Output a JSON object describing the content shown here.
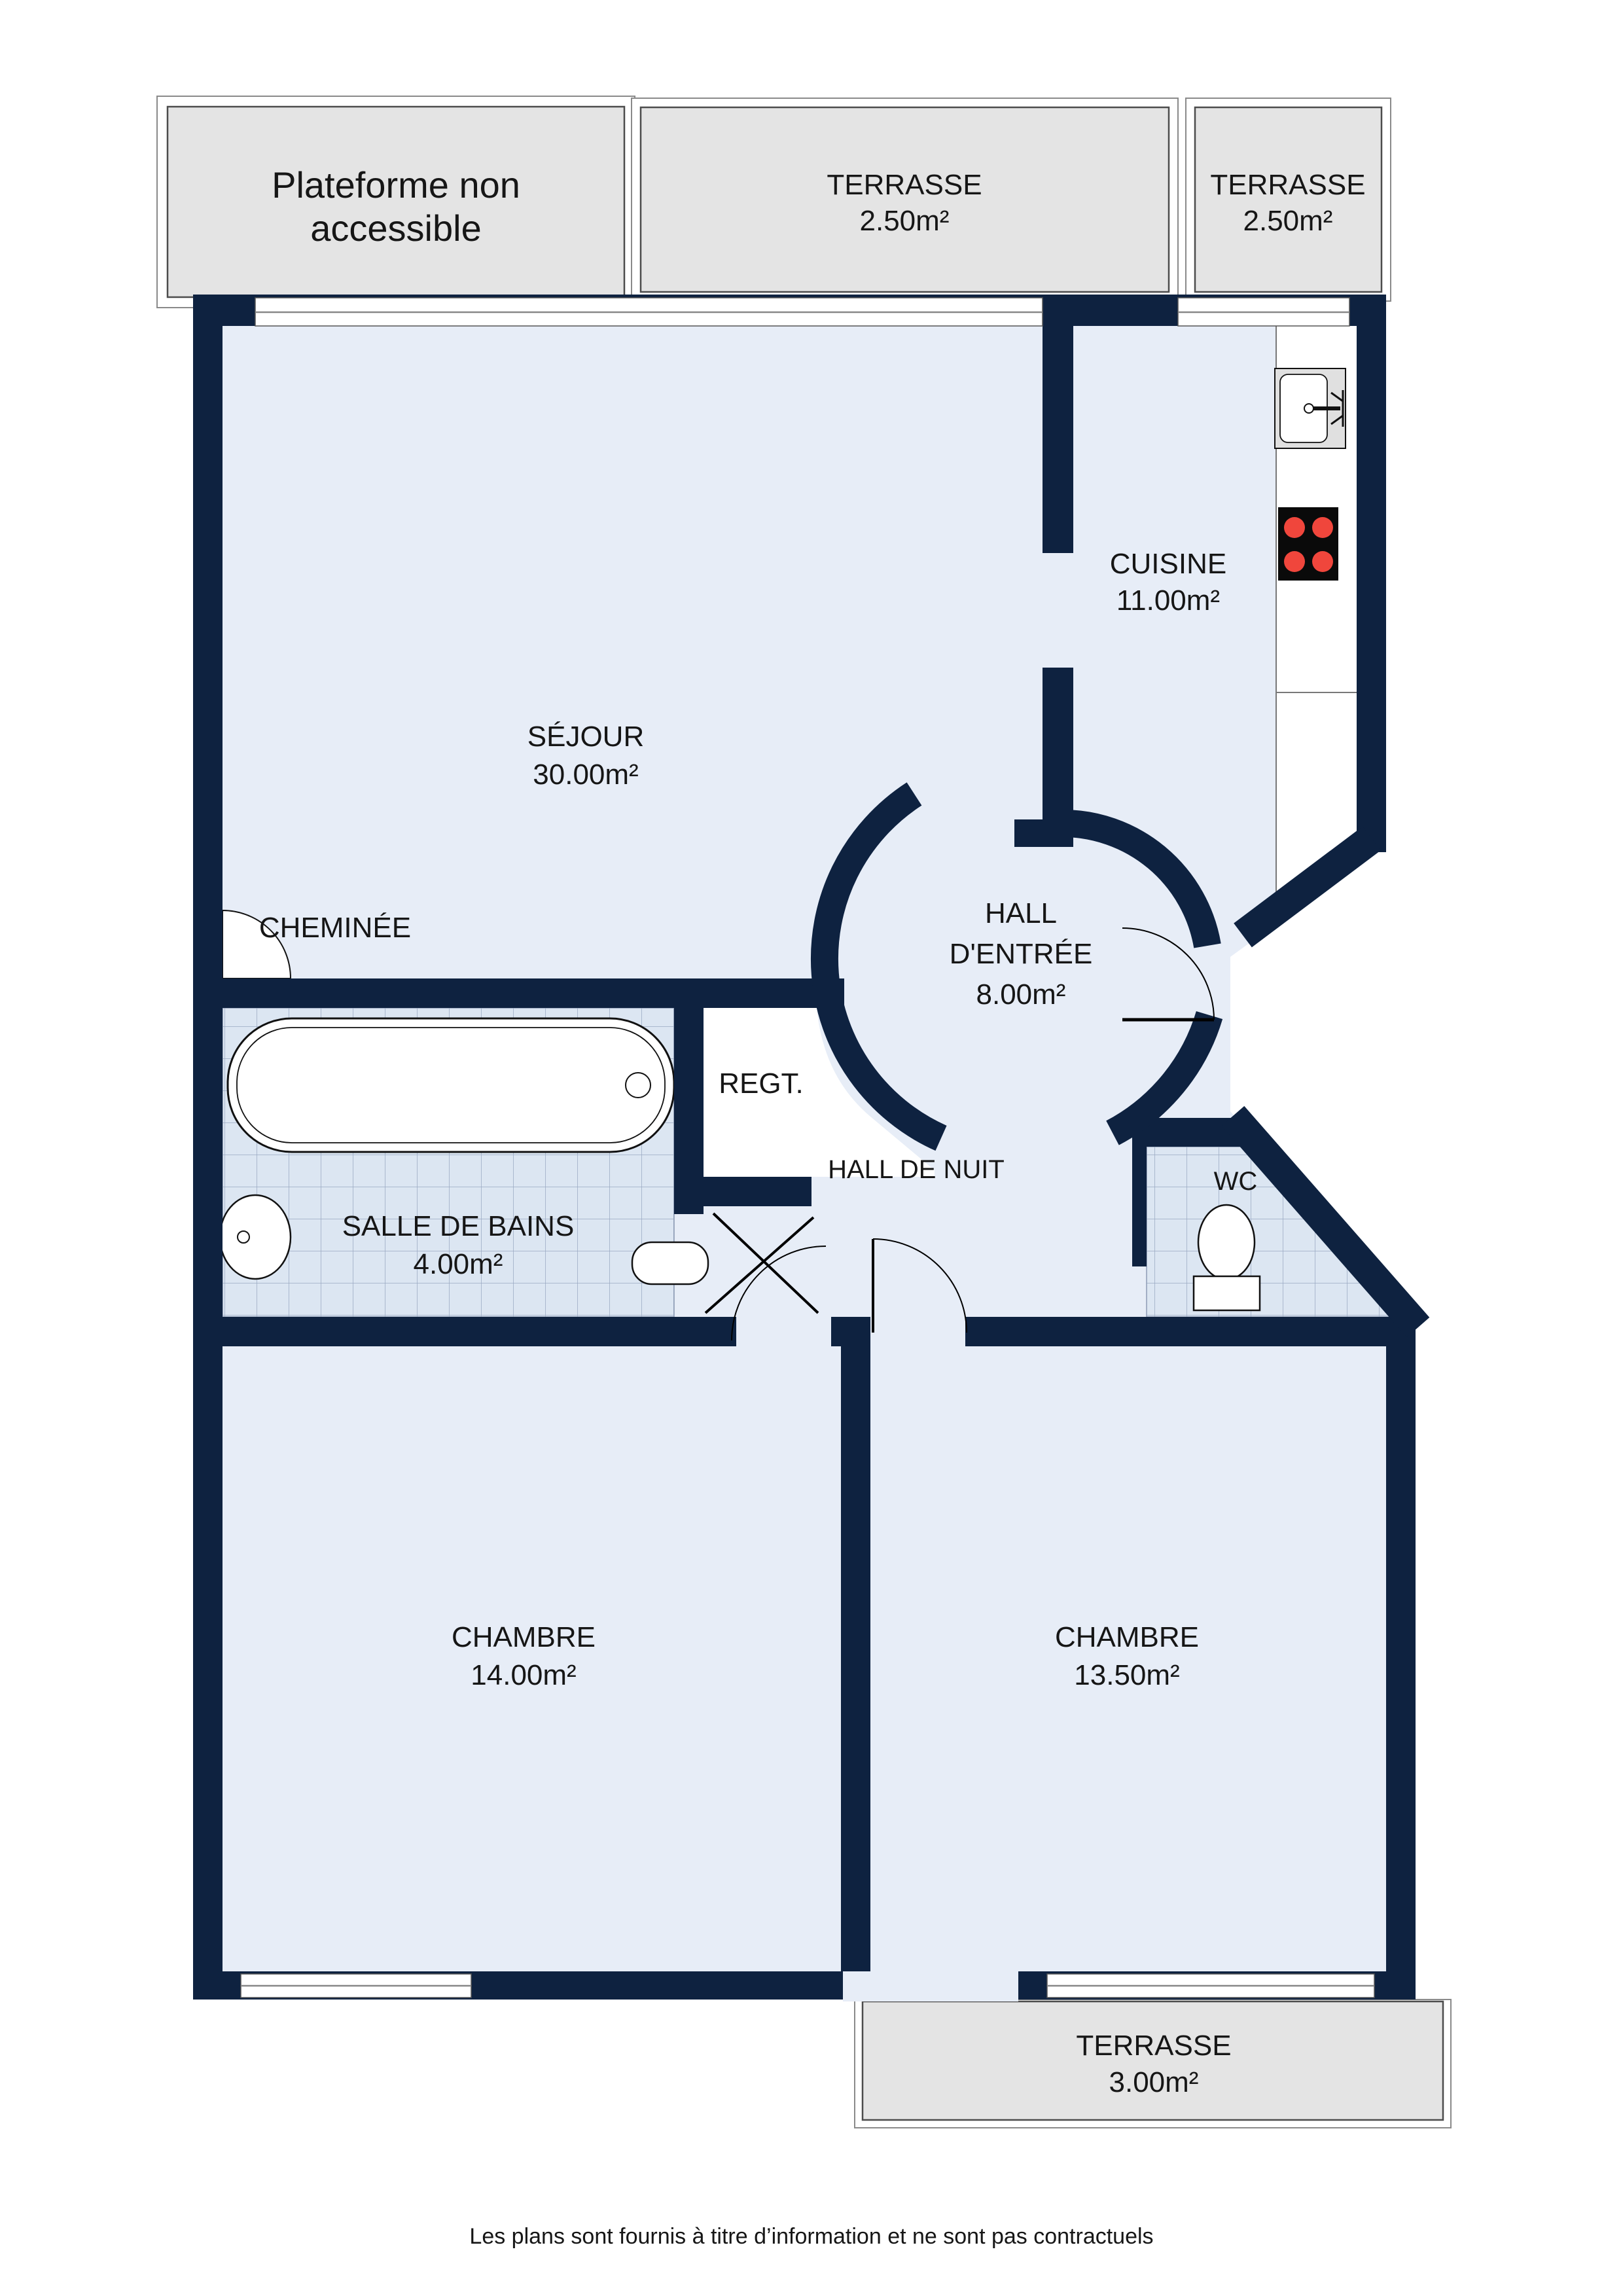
{
  "plan": {
    "note_box": {
      "line1": "Plateforme non",
      "line2": "accessible"
    },
    "terraces": {
      "top1": {
        "name": "TERRASSE",
        "area": "2.50m²"
      },
      "top2": {
        "name": "TERRASSE",
        "area": "2.50m²"
      },
      "bottom": {
        "name": "TERRASSE",
        "area": "3.00m²"
      }
    },
    "rooms": {
      "sejour": {
        "name": "SÉJOUR",
        "area": "30.00m²"
      },
      "cuisine": {
        "name": "CUISINE",
        "area": "11.00m²"
      },
      "hall_entree": {
        "line1": "HALL",
        "line2": "D'ENTRÉE",
        "area": "8.00m²"
      },
      "salle_de_bains": {
        "name": "SALLE DE BAINS",
        "area": "4.00m²"
      },
      "hall_de_nuit": {
        "name": "HALL DE NUIT"
      },
      "wc": {
        "name": "WC"
      },
      "regt": {
        "name": "REGT."
      },
      "cheminee": {
        "name": "CHEMINÉE"
      },
      "chambre_1": {
        "name": "CHAMBRE",
        "area": "14.00m²"
      },
      "chambre_2": {
        "name": "CHAMBRE",
        "area": "13.50m²"
      }
    },
    "fixtures": [
      "bathtub-icon",
      "washbasin-icon",
      "radiator-icon",
      "toilet-icon",
      "kitchen-sink-icon",
      "stove-4-burners-icon",
      "fireplace-icon"
    ],
    "colors": {
      "wall": "#0e2240",
      "room_fill": "#e7edf7",
      "tile_fill": "#dce6f2",
      "tile_line": "#9aa8c2",
      "terrace_fill": "#e4e4e4",
      "burner_red": "#f0463c"
    },
    "footer": "Les plans sont fournis à titre d’information et ne sont pas contractuels"
  }
}
